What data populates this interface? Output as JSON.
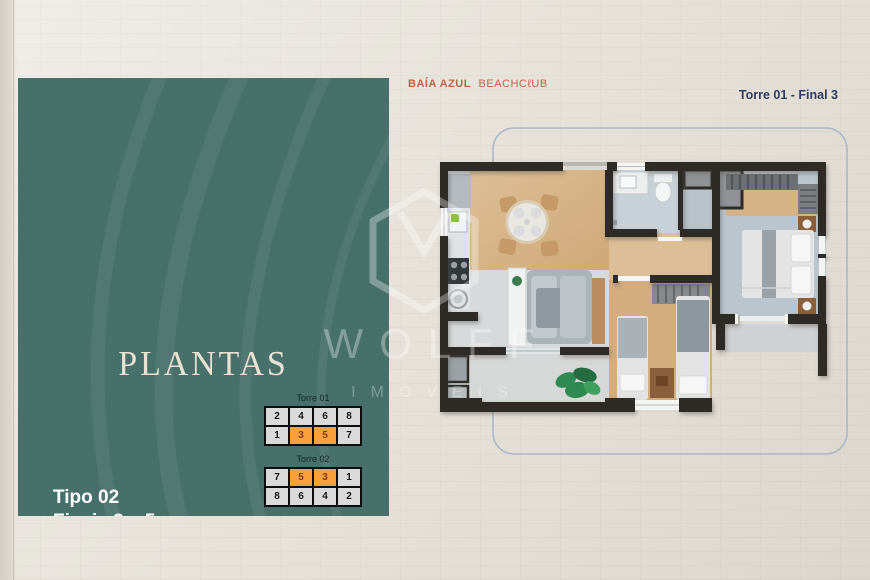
{
  "header": {
    "logo_bold": "BAÍA AZUL",
    "logo_light": "BEACHCℓUB",
    "unit_label": "Torre 01 - Final 3"
  },
  "panel": {
    "title": "PLANTAS",
    "type_line1": "Tipo 02",
    "type_line2": "Finais 3 e 5",
    "area_label": "Área apto:",
    "area_value": "52,48 m²",
    "towers": [
      {
        "label": "Torre 01",
        "rows": [
          [
            "2",
            "4",
            "6",
            "8"
          ],
          [
            "1",
            "3",
            "5",
            "7"
          ]
        ],
        "highlighted": [
          [
            1,
            1
          ],
          [
            1,
            2
          ]
        ]
      },
      {
        "label": "Torre 02",
        "rows": [
          [
            "7",
            "5",
            "3",
            "1"
          ],
          [
            "8",
            "6",
            "4",
            "2"
          ]
        ],
        "highlighted": [
          [
            0,
            1
          ],
          [
            0,
            2
          ]
        ]
      }
    ]
  },
  "watermark": {
    "name": "WOLFF",
    "subtitle": "IMÓVEIS"
  },
  "colors": {
    "panel_teal": "#47706a",
    "accent_orange": "#f9a23b",
    "brand_terracotta": "#c2604a",
    "navy": "#2e3c62",
    "background": "#e7e3db",
    "cream_text": "#e8e2d2",
    "cell_gray": "#dadada",
    "wall": "#2d2b28",
    "border_blue": "#a9b8c6",
    "wood": "#d7b78c",
    "tile": "#cdd4d8"
  }
}
